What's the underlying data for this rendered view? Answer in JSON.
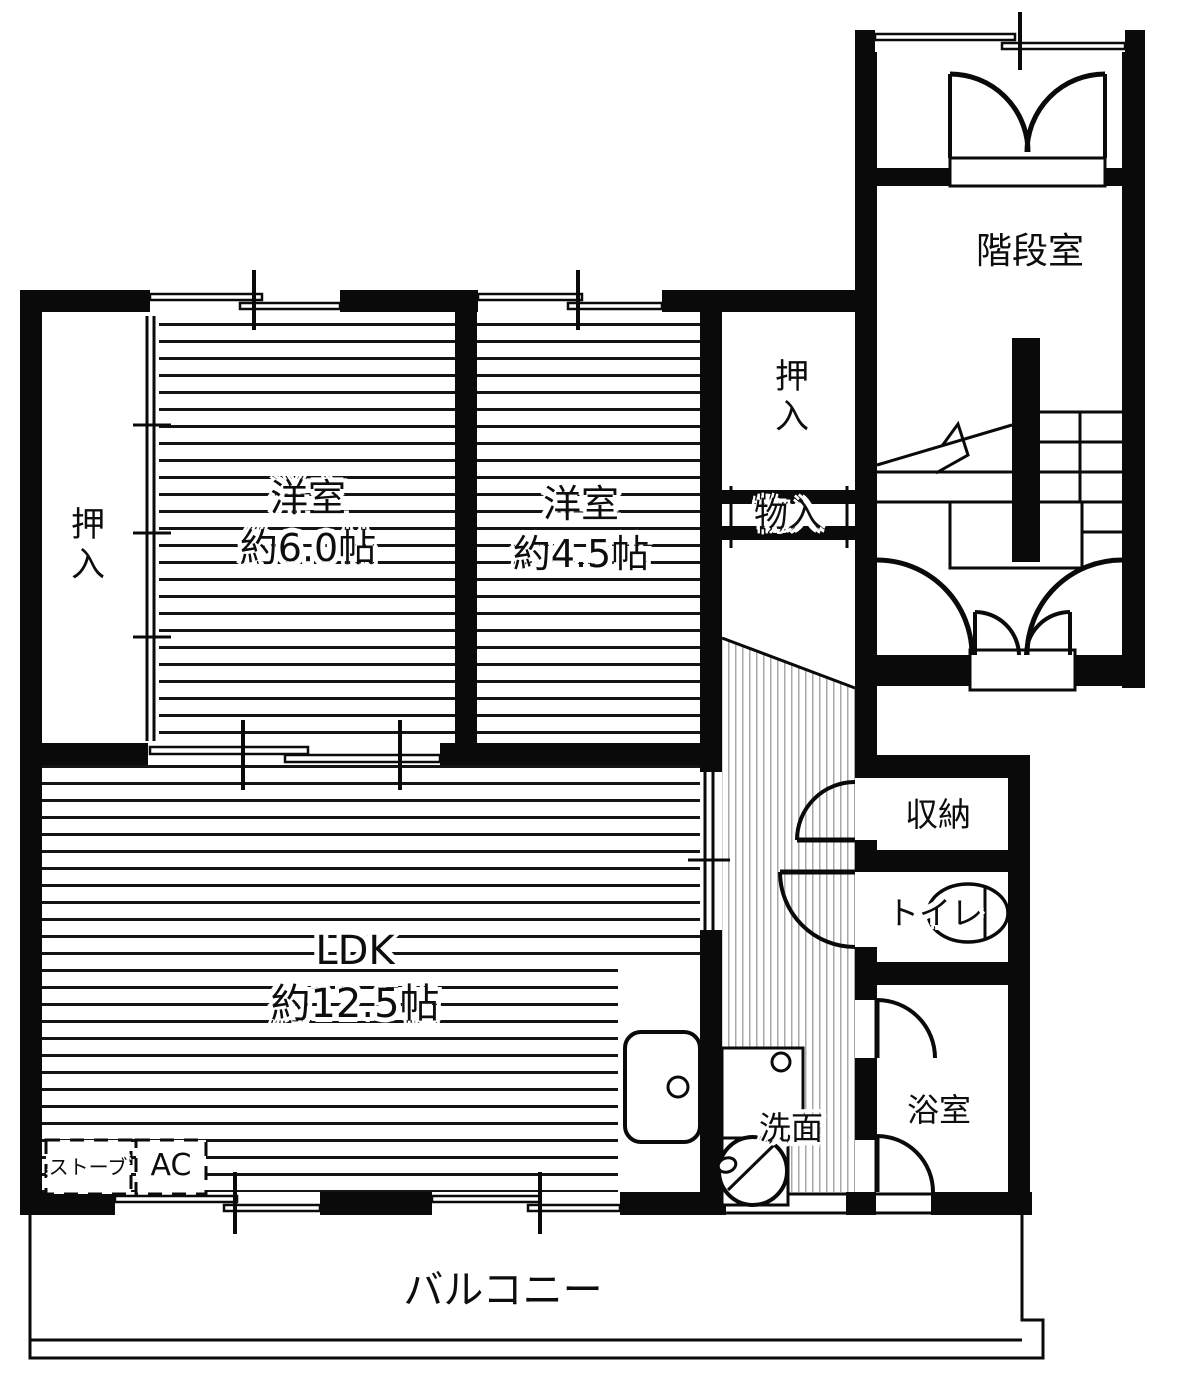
{
  "floorplan": {
    "rooms": {
      "stairwell": {
        "label": "階段室"
      },
      "closet_top": {
        "label": "押入"
      },
      "storage_shelf": {
        "label": "物入"
      },
      "closet_left": {
        "label": "押入"
      },
      "bedroom_6": {
        "label": "洋室",
        "size": "約6.0帖"
      },
      "bedroom_45": {
        "label": "洋室",
        "size": "約4.5帖"
      },
      "ldk": {
        "label": "LDK",
        "size": "約12.5帖"
      },
      "storage": {
        "label": "収納"
      },
      "toilet": {
        "label": "トイレ"
      },
      "bathroom": {
        "label": "浴室"
      },
      "washroom": {
        "label": "洗面"
      },
      "balcony": {
        "label": "バルコニー"
      }
    },
    "equipment": {
      "stove": {
        "label": "ストーブ"
      },
      "ac": {
        "label": "AC"
      }
    },
    "icons": {
      "toilet": "toilet-bowl-icon",
      "kitchen_sink": "kitchen-sink-icon",
      "washbasin": "washbasin-icon",
      "washer": "washing-machine-icon",
      "stairs": "stairs-icon",
      "doors": "door-swing-icon",
      "windows": "sliding-window-icon"
    },
    "colors": {
      "wall": "#0a0a0a",
      "background": "#ffffff",
      "floor_stripe": "#141414",
      "hall_stripe": "#a8a8a8"
    }
  }
}
